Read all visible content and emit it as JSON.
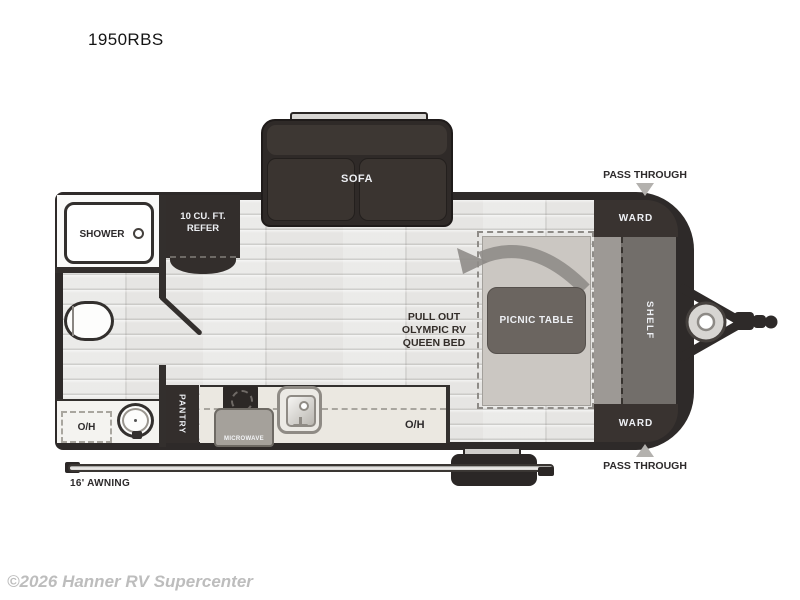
{
  "title": "1950RBS",
  "watermark": "©2026 Hanner RV Supercenter",
  "plan": {
    "sofa": "SOFA",
    "shower": "SHOWER",
    "refer_line1": "10 CU. FT.",
    "refer_line2": "REFER",
    "pullout_line1": "PULL OUT",
    "pullout_line2": "OLYMPIC RV",
    "pullout_line3": "QUEEN BED",
    "picnic_table": "PICNIC TABLE",
    "shelf": "SHELF",
    "ward_top": "WARD",
    "ward_bottom": "WARD",
    "pass_through_top": "PASS THROUGH",
    "pass_through_bottom": "PASS THROUGH",
    "pantry": "PANTRY",
    "microwave": "MICROWAVE",
    "overhead_kitchen": "O/H",
    "overhead_bath": "O/H",
    "awning": "16' AWNING"
  },
  "colors": {
    "wall": "#2e2a29",
    "furniture_dark": "#393330",
    "floor": "#e6e5e3",
    "bed": "#cbc7c2",
    "table_gray": "#6b6560",
    "arrow_gray": "#8f8c88",
    "counter": "#ebe8e1",
    "pass_through_arrow": "#b3b1ae",
    "watermark_gray": "#bdbdbd"
  }
}
